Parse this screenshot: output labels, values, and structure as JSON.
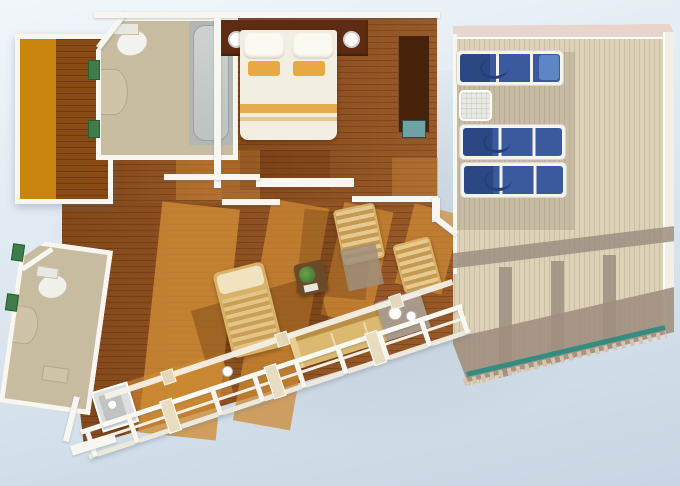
{
  "scene": {
    "type": "floor-plan",
    "subject": "Isometric floor plan of a ship suite with wrap balcony and private sun deck",
    "rooms": [
      {
        "id": "wardrobe-room",
        "label": "Wardrobe room"
      },
      {
        "id": "bathroom-upper",
        "label": "Bathroom with bathtub"
      },
      {
        "id": "bedroom",
        "label": "Bedroom"
      },
      {
        "id": "hallway",
        "label": "Hallway"
      },
      {
        "id": "living-room",
        "label": "Living room"
      },
      {
        "id": "bathroom-lower",
        "label": "Guest bathroom"
      },
      {
        "id": "balcony",
        "label": "Balcony with railing"
      },
      {
        "id": "sun-deck",
        "label": "Private sun deck"
      }
    ],
    "furniture": {
      "bed": {
        "count": 1,
        "pillows": 2,
        "accent_pillows": 2,
        "accent_color": "#e8a844"
      },
      "sun_loungers": {
        "count": 3,
        "cushion_color": "#3b5a9e"
      },
      "deck_side_table": {
        "count": 1
      },
      "bathtub": {
        "count": 1
      },
      "toilets": {
        "count": 2
      },
      "balcony_sofa": {
        "count": 1
      },
      "balcony_table": {
        "count": 1
      },
      "chairs": {
        "count": 2
      },
      "chaise_lounge": {
        "count": 1
      },
      "coffee_table_with_plant": {
        "count": 1
      },
      "tv_cabinet": {
        "count": 1
      }
    },
    "railing": {
      "white_posts": 10,
      "accent_posts": 3,
      "glass_color": "#2e8b80"
    },
    "palette": {
      "background_top": "#f1f6fa",
      "background_bottom": "#c8d6e3",
      "wood_floor": "#93511d",
      "wood_sunlit": "#d08d36",
      "closet_orange": "#c8860d",
      "bath_floor": "#c7bba0",
      "deck_plank": "#ddd2b8",
      "deck_shadow": "#9e8f80",
      "lounger_blue": "#3b5a9e",
      "headboard_brown": "#5d2c12",
      "wall_white": "#f8f6f0",
      "glass_teal": "#2e8b80",
      "accent_green": "#3e7c49"
    }
  }
}
